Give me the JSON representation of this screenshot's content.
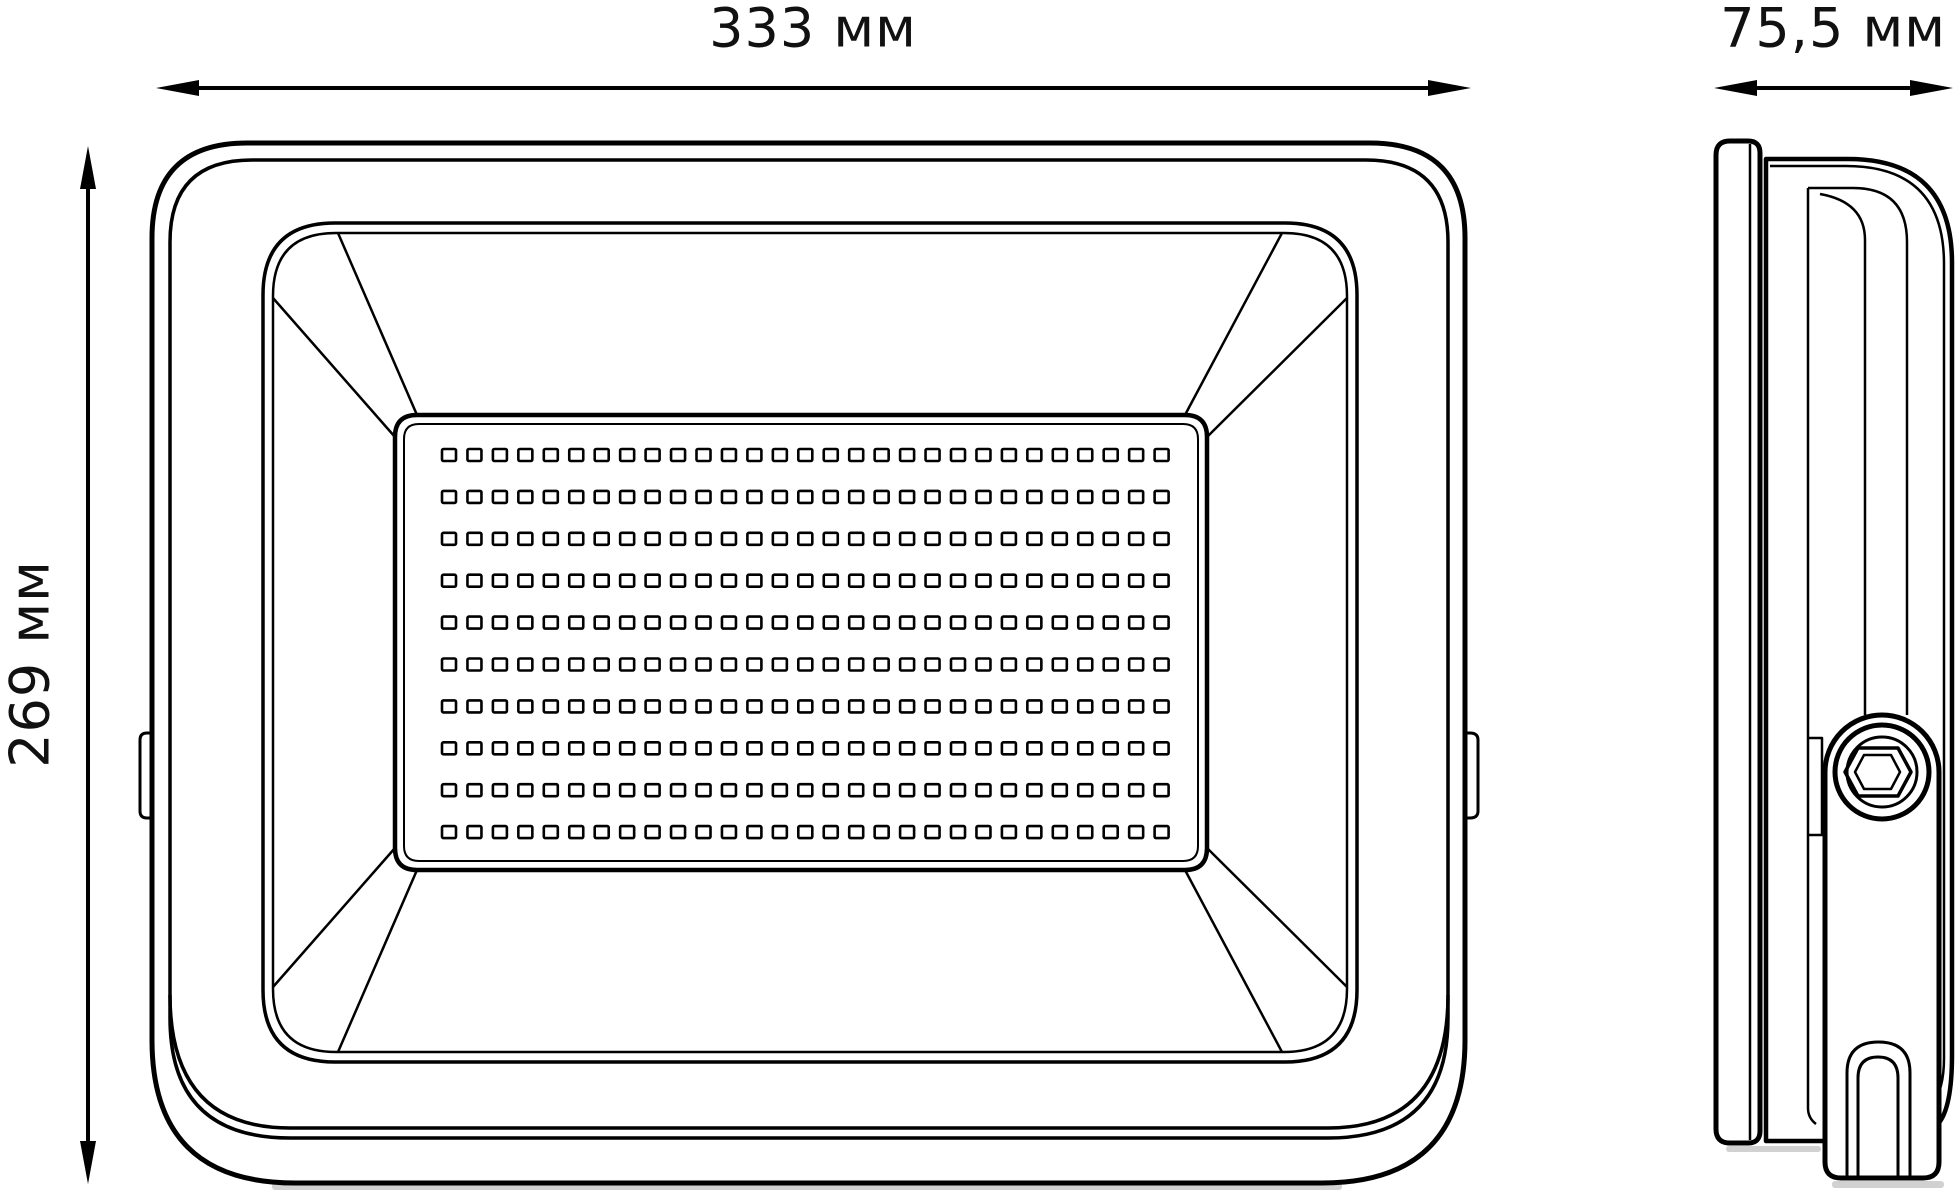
{
  "title": "LED floodlight dimensional drawing",
  "dimensions": {
    "width_label": "333 мм",
    "height_label": "269 мм",
    "depth_label": "75,5 мм"
  },
  "led_grid": {
    "rows": 10,
    "cols": 29
  },
  "colors": {
    "line": "#000000",
    "background": "#ffffff",
    "shadow": "#c9c9c9",
    "text": "#111111"
  }
}
